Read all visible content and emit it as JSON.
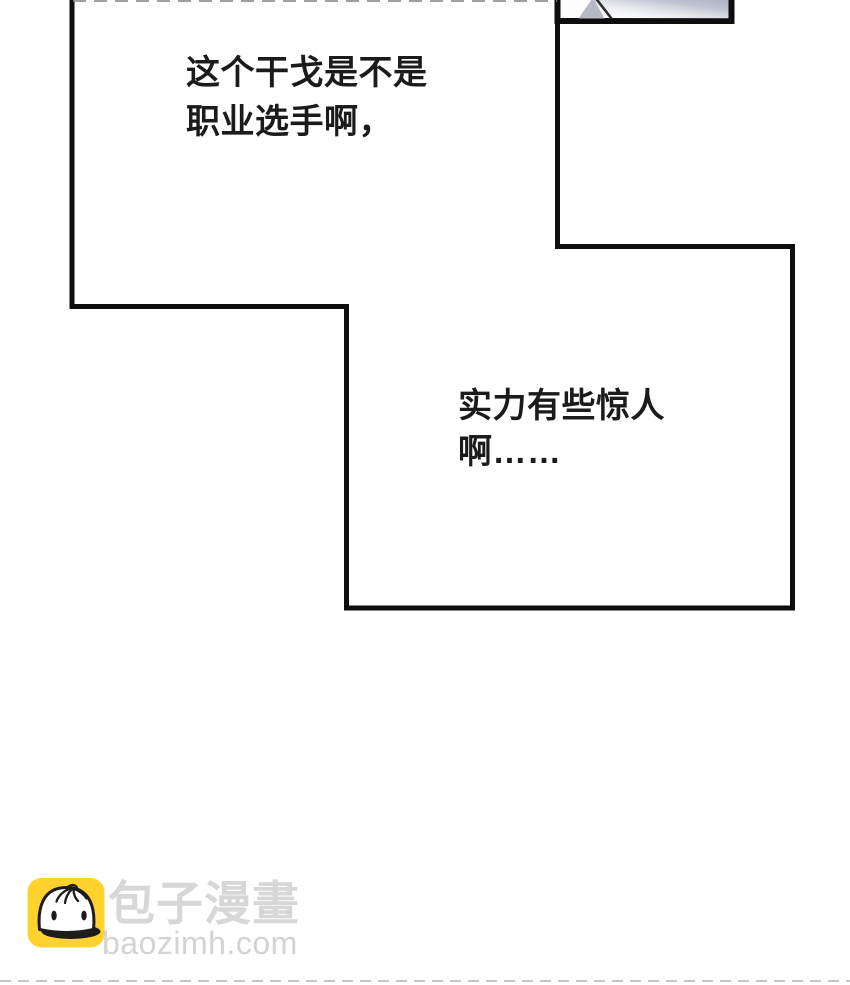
{
  "page": {
    "width": 850,
    "height": 985,
    "background_color": "#ffffff"
  },
  "panels": {
    "border_color": "#0e0e0e",
    "fragment_box": {
      "description": "cropped grayscale artwork fragment in small bordered box, cut off at top of image",
      "shade_color": "#aab0c4",
      "triangle_color": "#b7bac5",
      "edge_line_color": "#2e2e30"
    }
  },
  "speech": {
    "text_color": "#1b1b1b",
    "bubble1": {
      "line1": "这个干戈是不是",
      "line2": "职业选手啊，"
    },
    "bubble2": {
      "line1": "实力有些惊人",
      "line2": "啊……"
    }
  },
  "watermark": {
    "site_name": "包子漫畫",
    "site_domain": "baozimh.com",
    "name_color": "#d7d7d7",
    "domain_color": "#d3d3d3",
    "icon": "baozi-mascot-icon",
    "icon_bg_color": "#ffd22e",
    "icon_line_color": "#1c1c1c"
  }
}
